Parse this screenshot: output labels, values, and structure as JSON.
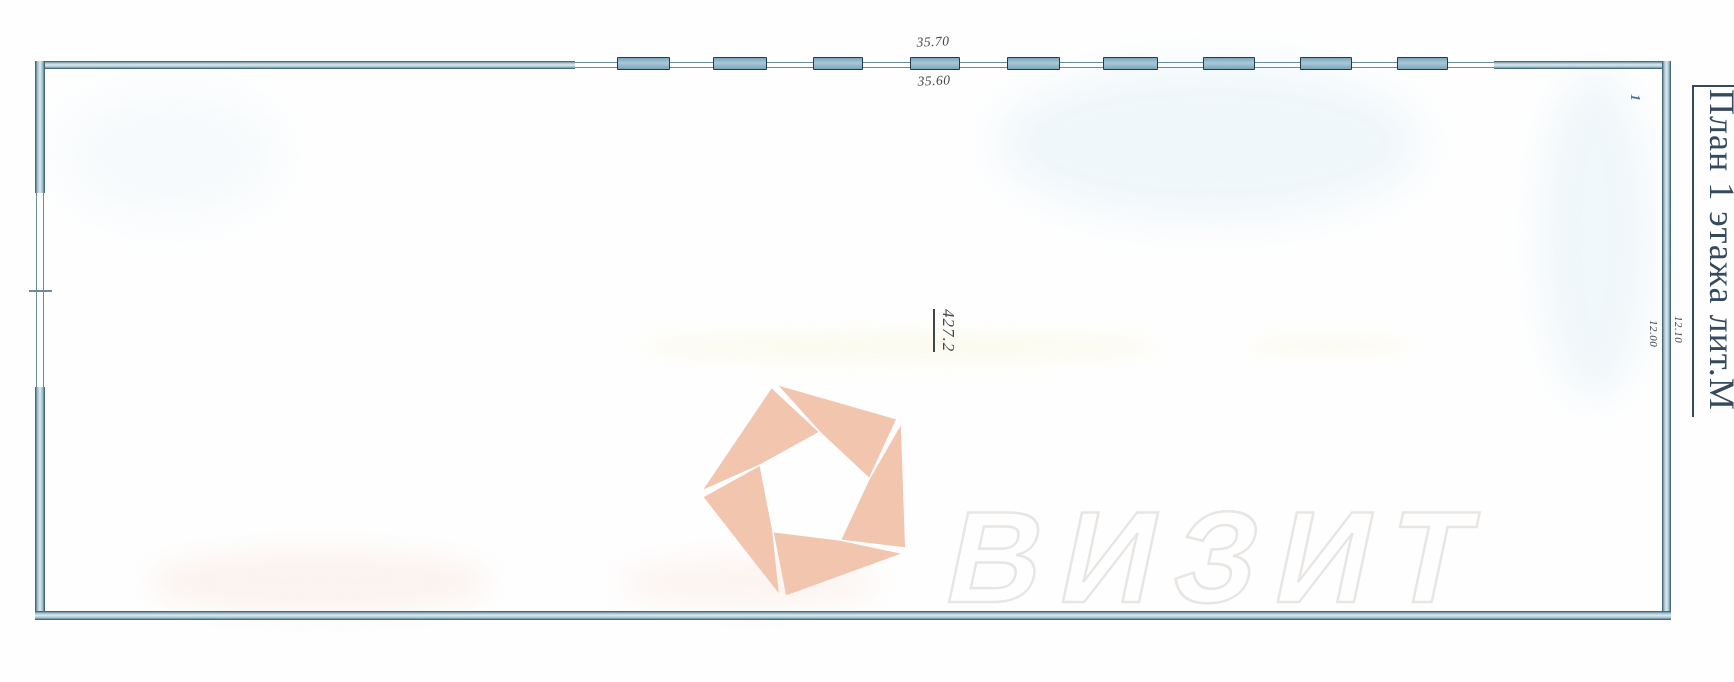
{
  "title": {
    "text": "План 1 этажа лит.М"
  },
  "plan": {
    "room_area_label": "427.2",
    "room_number": "1",
    "dimensions": {
      "top_outer": "35.70",
      "top_inner": "35.60",
      "right_outer": "12.10",
      "right_inner": "12.00"
    }
  },
  "watermark": {
    "text": "ВИЗИТ",
    "logo": "aperture-pentagon-logo"
  },
  "colors": {
    "wall_fill": "#9fbecb",
    "wall_border": "#2f5163",
    "wall_highlight": "#dcebf1",
    "window_fill": "#7aa6bd",
    "window_border": "#1e3d53",
    "thin_line": "#6b8d99",
    "title_color": "#35495f",
    "dimension_color": "#3f454c",
    "room_number_color": "#4a6fae",
    "watermark_logo_color": "#f2c5af",
    "watermark_outline_color": "#e8e5e2"
  }
}
